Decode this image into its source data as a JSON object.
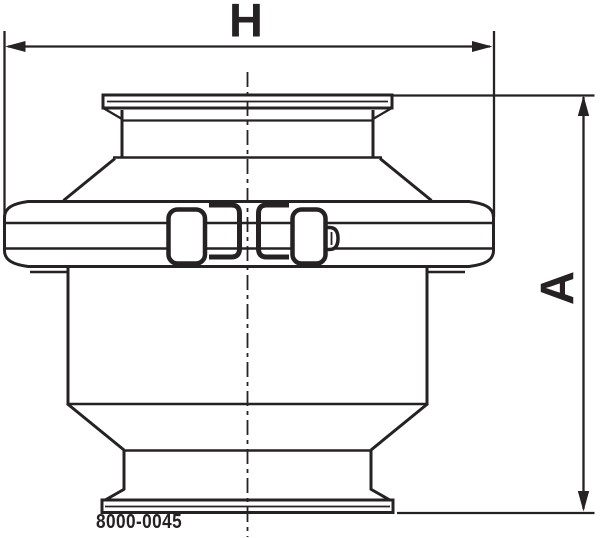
{
  "canvas": {
    "width": 600,
    "height": 538,
    "background": "#ffffff"
  },
  "colors": {
    "line": "#262122"
  },
  "dimension_labels": {
    "horizontal": "H",
    "vertical": "A"
  },
  "part_number": "8000-0045"
}
